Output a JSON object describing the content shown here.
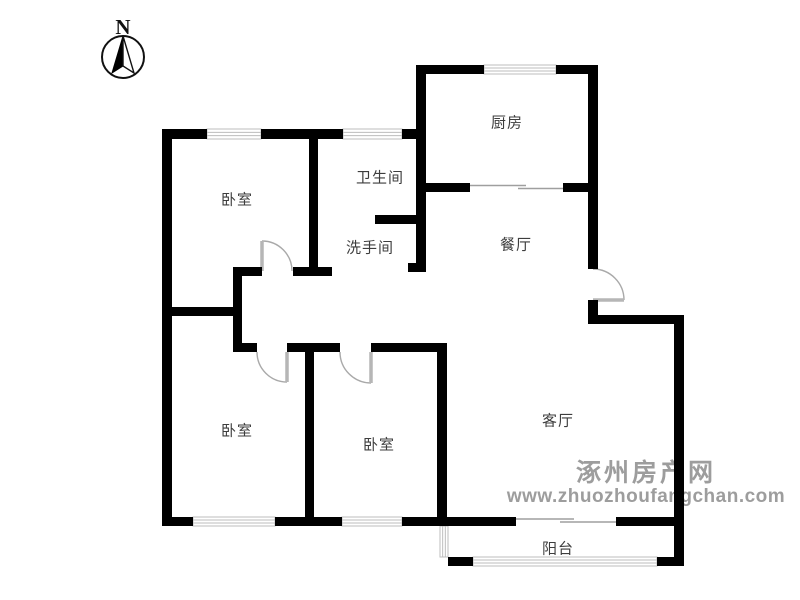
{
  "north_indicator": {
    "label": "N",
    "cx": 123,
    "cy": 57,
    "r": 21
  },
  "watermark": {
    "line1": "涿州房产网",
    "line2": "www.zhuozhoufangchan.com",
    "color": "#969696",
    "cx": 646,
    "line1_baseline_y": 481,
    "line2_baseline_y": 502
  },
  "rooms": [
    {
      "id": "bedroom-north",
      "label": "卧室",
      "cx": 237,
      "cy": 199
    },
    {
      "id": "bathroom",
      "label": "卫生间",
      "cx": 380,
      "cy": 177
    },
    {
      "id": "washroom",
      "label": "洗手间",
      "cx": 370,
      "cy": 247
    },
    {
      "id": "kitchen",
      "label": "厨房",
      "cx": 507,
      "cy": 122
    },
    {
      "id": "dining-room",
      "label": "餐厅",
      "cx": 516,
      "cy": 244
    },
    {
      "id": "bedroom-southwest",
      "label": "卧室",
      "cx": 237,
      "cy": 430
    },
    {
      "id": "bedroom-south",
      "label": "卧室",
      "cx": 379,
      "cy": 444
    },
    {
      "id": "living-room",
      "label": "客厅",
      "cx": 558,
      "cy": 420
    },
    {
      "id": "balcony",
      "label": "阳台",
      "cx": 558,
      "cy": 548
    }
  ],
  "floorplan": {
    "wall_color": "#000000",
    "window_color": "#bdbdbd",
    "door_arc_color": "#a9a9a9",
    "door_leaf_color": "#b6b6b6",
    "opening_color": "#9f9f9f",
    "walls": [
      [
        162,
        129,
        10,
        396
      ],
      [
        162,
        129,
        45,
        10
      ],
      [
        261,
        129,
        82,
        10
      ],
      [
        402,
        129,
        24,
        10
      ],
      [
        416,
        65,
        10,
        207
      ],
      [
        408,
        263,
        18,
        9
      ],
      [
        416,
        65,
        68,
        9
      ],
      [
        556,
        65,
        42,
        9
      ],
      [
        588,
        65,
        10,
        204
      ],
      [
        588,
        300,
        10,
        24
      ],
      [
        588,
        315,
        96,
        9
      ],
      [
        674,
        315,
        10,
        250
      ],
      [
        162,
        517,
        31,
        9
      ],
      [
        275,
        517,
        67,
        9
      ],
      [
        402,
        517,
        114,
        9
      ],
      [
        616,
        517,
        62,
        9
      ],
      [
        448,
        557,
        25,
        9
      ],
      [
        657,
        557,
        27,
        9
      ],
      [
        309,
        138,
        9,
        130
      ],
      [
        233,
        267,
        29,
        9
      ],
      [
        293,
        267,
        39,
        9
      ],
      [
        233,
        267,
        9,
        85
      ],
      [
        162,
        307,
        80,
        9
      ],
      [
        233,
        343,
        24,
        9
      ],
      [
        287,
        343,
        53,
        9
      ],
      [
        371,
        343,
        76,
        9
      ],
      [
        305,
        348,
        9,
        169
      ],
      [
        437,
        343,
        10,
        174
      ],
      [
        375,
        215,
        51,
        9
      ],
      [
        426,
        183,
        44,
        9
      ],
      [
        563,
        183,
        25,
        9
      ]
    ],
    "windows": [
      [
        207,
        129,
        54,
        10,
        "h"
      ],
      [
        343,
        129,
        59,
        10,
        "h"
      ],
      [
        484,
        65,
        72,
        9,
        "h"
      ],
      [
        193,
        517,
        82,
        9,
        "h"
      ],
      [
        342,
        517,
        60,
        9,
        "h"
      ],
      [
        440,
        526,
        8,
        31,
        "v"
      ],
      [
        473,
        557,
        184,
        9,
        "h"
      ]
    ],
    "openings": [
      [
        470,
        185.5,
        526,
        185.5
      ],
      [
        518,
        188.5,
        563,
        188.5
      ],
      [
        516,
        519,
        574,
        519
      ],
      [
        560,
        522,
        616,
        522
      ]
    ],
    "doors": [
      [
        262,
        271,
        30,
        -90,
        0
      ],
      [
        287,
        352,
        30,
        90,
        180
      ],
      [
        371,
        352,
        31,
        90,
        180
      ],
      [
        593,
        300,
        31,
        0,
        -90
      ]
    ]
  }
}
